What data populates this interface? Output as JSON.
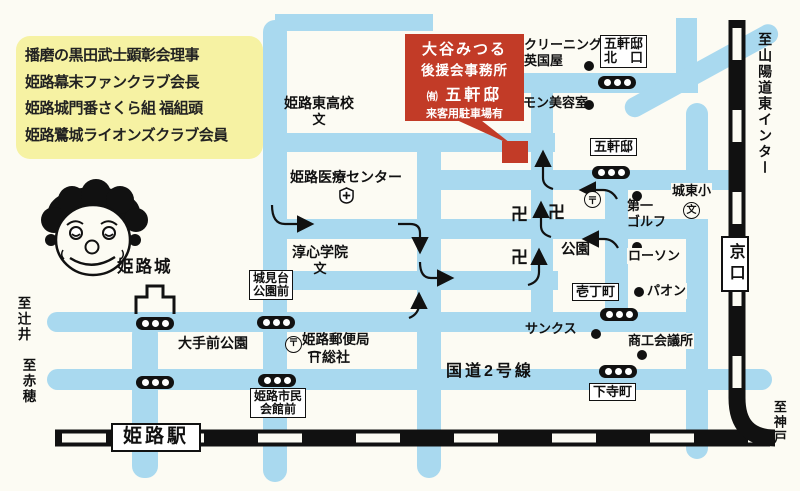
{
  "title_box": {
    "line1": "播磨の黒田武士顕彰会理事",
    "line2": "姫路幕末ファンクラブ会長",
    "line3": "姫路城門番さくら組 福組頭",
    "line4": "姫路鷺城ライオンズクラブ会員"
  },
  "callout": {
    "name": "大谷みつる",
    "org": "後援会事務所",
    "company_prefix": "㈲",
    "company": "五軒邸",
    "note": "来客用駐車場有"
  },
  "boxes": {
    "gokentei_north_l1": "五軒邸",
    "gokentei_north_l2": "北　口",
    "gokentei": "五軒邸",
    "icchomachi": "壱丁町",
    "shimodera": "下寺町",
    "shiromidai_l1": "城見台",
    "shiromidai_l2": "公園前",
    "shimin_l1": "姫路市民",
    "shimin_l2": "会館前",
    "himeji_station": "姫路駅",
    "kyoguchi": "京口"
  },
  "places": {
    "cleaning_l1": "クリーニング",
    "cleaning_l2": "英国屋",
    "mon_beauty": "モン美容室",
    "higashi_hs": "姫路東高校",
    "medical": "姫路医療センター",
    "junshin": "淳心学院",
    "castle": "姫路城",
    "otemae_park": "大手前公園",
    "post_office": "姫路郵便局",
    "soja": "総社",
    "joto_es": "城東小",
    "golf_l1": "第一",
    "golf_l2": "ゴルフ",
    "lawson": "ローソン",
    "paon": "パオン",
    "sunkus": "サンクス",
    "chamber": "商工会議所",
    "park": "公園",
    "route2": "国道2号線"
  },
  "symbols": {
    "temple1": "卍",
    "temple2": "卍",
    "temple3": "卍",
    "school_mark": "文",
    "school_mark2": "文",
    "school_mark3": "文",
    "post_mark": "〒",
    "post_mark2": "〒"
  },
  "directions": {
    "tsujii": "至辻井",
    "ako": "至赤穂",
    "sanyo": "至山陽道東インター",
    "kobe": "至神戸"
  },
  "colors": {
    "road": "#a9d9ef",
    "rail": "#111111",
    "accent_red": "#c23b27",
    "info_yellow": "#f6f2a3"
  }
}
